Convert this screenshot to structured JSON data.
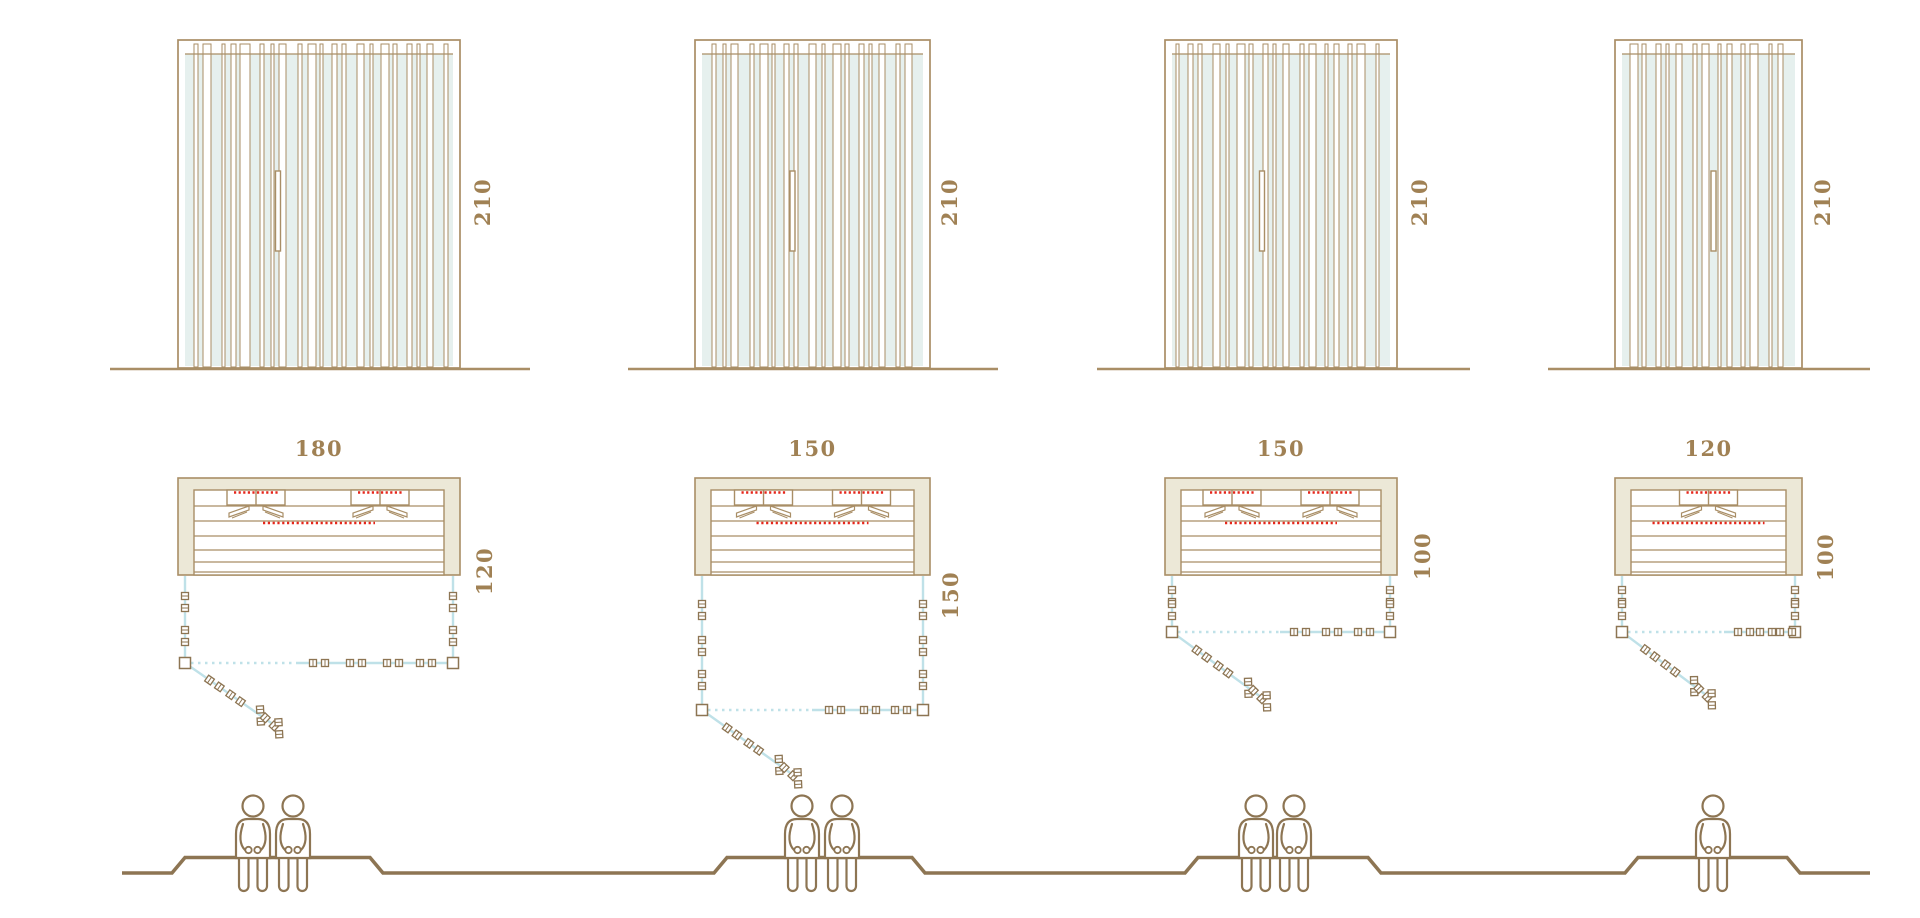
{
  "models": [
    {
      "height_cm": "210",
      "width_cm": "180",
      "depth_cm": "120",
      "seated_capacity": 2
    },
    {
      "height_cm": "210",
      "width_cm": "150",
      "depth_cm": "150",
      "seated_capacity": 2
    },
    {
      "height_cm": "210",
      "width_cm": "150",
      "depth_cm": "100",
      "seated_capacity": 2
    },
    {
      "height_cm": "210",
      "width_cm": "120",
      "depth_cm": "100",
      "seated_capacity": 1
    }
  ],
  "colors": {
    "wood_outline": "#a98e66",
    "wood_dark": "#8d7553",
    "dimension_text": "#a08154",
    "glass_fill": "#e6f0ee",
    "frame_fill": "#ece8d7",
    "heater_red": "#e5261b",
    "door_track_blue": "#bfe1e8",
    "background": "#ffffff"
  }
}
